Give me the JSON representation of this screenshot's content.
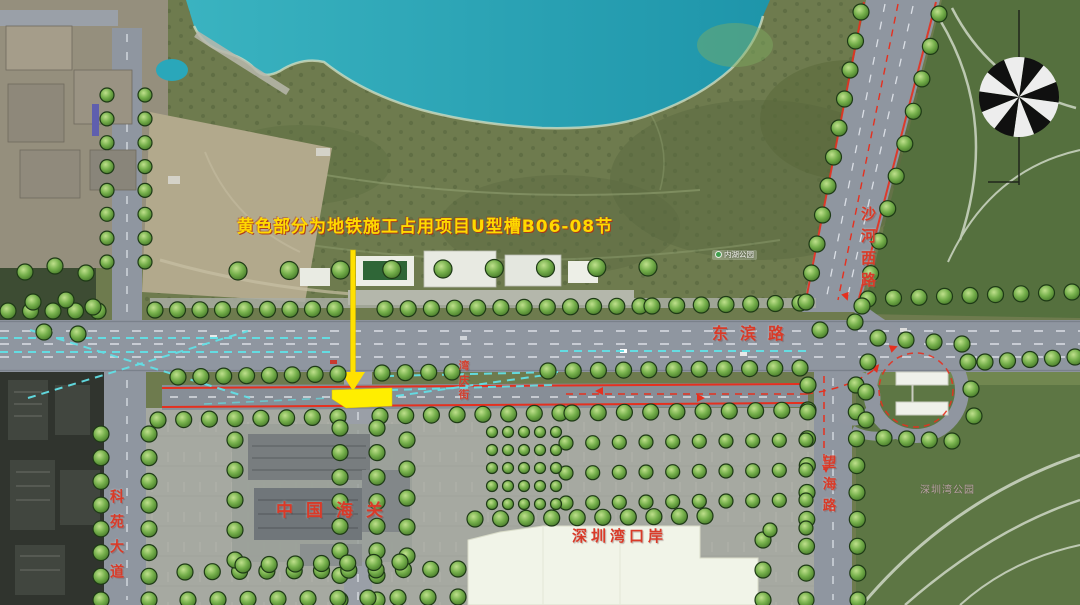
{
  "map_title": {
    "construction_note": "黄色部分为地铁施工占用项目U型槽B06-08节"
  },
  "road_labels": {
    "dongbin_road": "东滨路",
    "shahe_west_road": "沙河西路",
    "keyuan_avenue": "科苑大道",
    "wanghai_road": "望海路",
    "wanqing_street": "湾庆街"
  },
  "place_labels": {
    "china_customs": "中国海关",
    "shenzhen_bay_port": "深圳湾口岸",
    "inner_lake_park": "内湖公园",
    "shenzhen_bay_park": "深圳湾公园"
  },
  "icons": {
    "compass": "compass-rose-icon"
  },
  "colors": {
    "highlight_yellow": "#ffee00",
    "annotation_yellow": "#ffd900",
    "label_red": "#d93a28",
    "route_dash_red": "#e5301f",
    "traffic_dash_cyan": "#63e0e6",
    "water_teal": "#2aa7ba"
  }
}
